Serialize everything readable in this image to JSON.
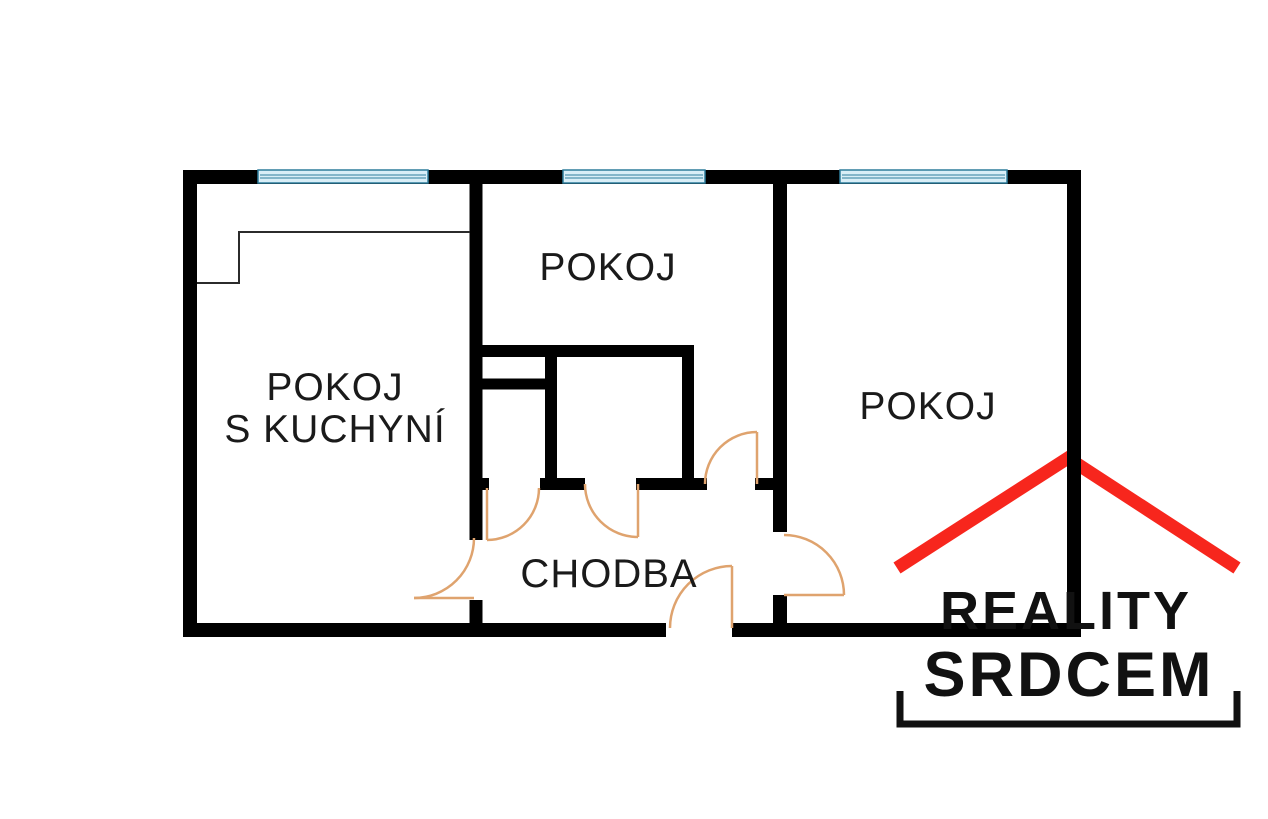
{
  "title": "Floor plan",
  "floor_plan": {
    "rooms": {
      "living_kitchen": {
        "line1": "POKOJ",
        "line2": "S KUCHYNÍ"
      },
      "room_top": {
        "label": "POKOJ"
      },
      "room_right": {
        "label": "POKOJ"
      },
      "hallway": {
        "label": "CHODBA"
      }
    },
    "colors": {
      "wall": "#000000",
      "window_fill": "#d8eef7",
      "window_line": "#2e7d9c",
      "door_arc": "#dfa36e",
      "label_text": "#1a1a1a"
    }
  },
  "logo": {
    "line1": "REALITY",
    "line2": "SRDCEM",
    "roof_color": "#f7261d",
    "text_color": "#111111"
  }
}
